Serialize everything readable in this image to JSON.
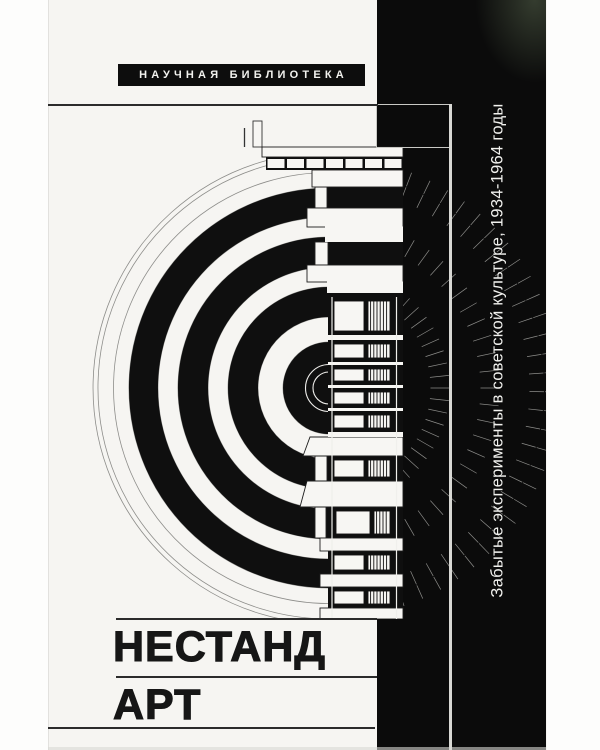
{
  "cover": {
    "series_label": "НАУЧНАЯ БИБЛИОТЕКА",
    "title_line1": "НЕСТАНД",
    "title_line2": "АРТ",
    "spine_text": "Забытые эксперименты в советской культуре, 1934-1964 годы",
    "artwork_name": "amphitheater-plan-and-facade-drawing",
    "colors": {
      "paper": "#f6f5f2",
      "band_black": "#0b0b0b",
      "ink": "#0f0f0f",
      "line_gray": "#8d8d8a",
      "spoke_white": "#f0efec",
      "edge_light": "#d8d8d4"
    }
  }
}
